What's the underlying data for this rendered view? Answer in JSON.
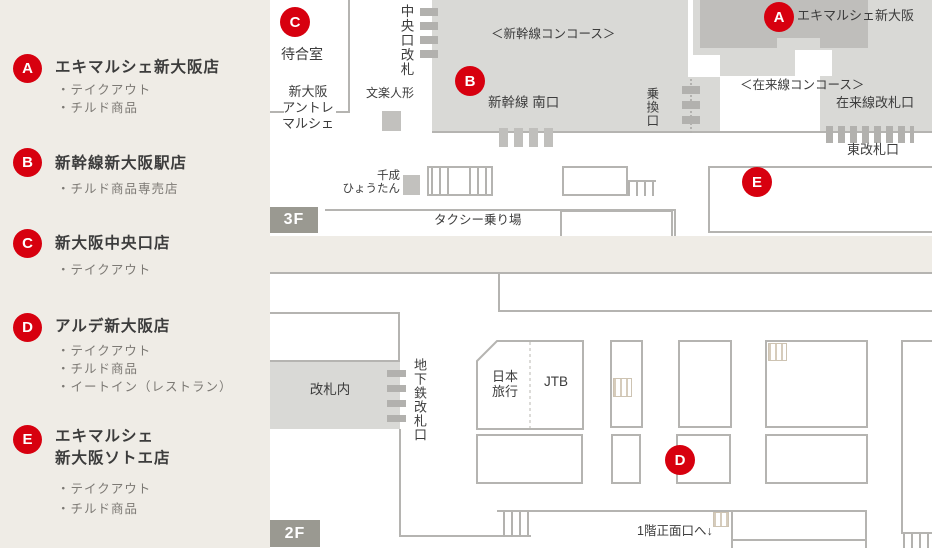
{
  "colors": {
    "background": "#efece6",
    "panel": "#ffffff",
    "concourse_gray": "#d9d9d6",
    "store_gray": "#bfbebb",
    "wall_gray": "#b5b4b1",
    "badge_gray": "#9a9991",
    "marker_red": "#d7000f",
    "text_dark": "#3c3c3c",
    "text_sub": "#7c7974"
  },
  "legend": {
    "items": [
      {
        "marker": "A",
        "title": "エキマルシェ新大阪店",
        "features": [
          "・テイクアウト",
          "・チルド商品"
        ]
      },
      {
        "marker": "B",
        "title": "新幹線新大阪駅店",
        "features": [
          "・チルド商品専売店"
        ]
      },
      {
        "marker": "C",
        "title": "新大阪中央口店",
        "features": [
          "・テイクアウト"
        ]
      },
      {
        "marker": "D",
        "title": "アルデ新大阪店",
        "features": [
          "・テイクアウト",
          "・チルド商品",
          "・イートイン（レストラン）"
        ]
      },
      {
        "marker": "E",
        "title": "エキマルシェ",
        "title2": "新大阪ソトエ店",
        "features": [
          "・テイクアウト",
          "・チルド商品"
        ]
      }
    ]
  },
  "map3f": {
    "floor_label": "3F",
    "markers": {
      "a": "A",
      "b": "B",
      "c": "C",
      "e": "E"
    },
    "labels": {
      "waiting_room": "待合室",
      "entre1": "新大阪",
      "entre2": "アントレ",
      "entre3": "マルシェ",
      "central_gate": "中央口改札",
      "bunraku": "文楽人形",
      "shinkansen_concourse": "＜新幹線コンコース＞",
      "shinkansen_south_gate": "新幹線 南口",
      "ekimarche_shinosaka": "エキマルシェ新大阪",
      "zairai_concourse": "＜在来線コンコース＞",
      "zairai_gate": "在来線改札口",
      "transfer_gate": "乗換口",
      "east_gate": "東改札口",
      "sennari1": "千成",
      "sennari2": "ひょうたん",
      "taxi_stand": "タクシー乗り場"
    }
  },
  "map2f": {
    "floor_label": "2F",
    "markers": {
      "d": "D"
    },
    "labels": {
      "inside_gate": "改札内",
      "subway_gate": "地下鉄改札口",
      "nippon_travel1": "日本",
      "nippon_travel2": "旅行",
      "jtb": "JTB",
      "to_1f_front": "1階正面口へ↓"
    }
  }
}
